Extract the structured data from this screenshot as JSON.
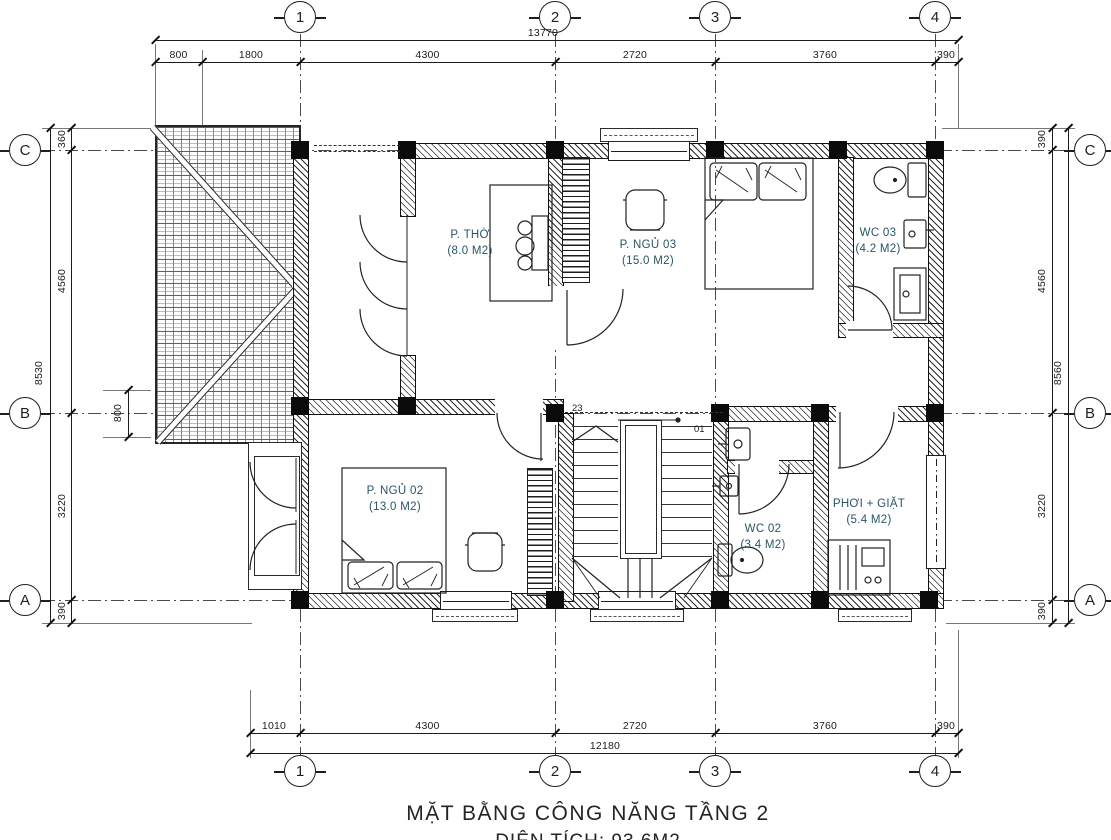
{
  "title": {
    "line1": "MẶT BẰNG CÔNG NĂNG TẦNG 2",
    "line2": "DIỆN TÍCH: 93.6M2"
  },
  "grid": {
    "cols": [
      "1",
      "2",
      "3",
      "4"
    ],
    "rows": [
      "C",
      "B",
      "A"
    ]
  },
  "dims": {
    "top": {
      "overall": "13770",
      "segments": [
        "800",
        "1800",
        "4300",
        "2720",
        "3760",
        "390"
      ]
    },
    "bottom": {
      "overall": "12180",
      "segments": [
        "1010",
        "4300",
        "2720",
        "3760",
        "390"
      ]
    },
    "left": {
      "overall": "8530",
      "segments": [
        "360",
        "4560",
        "3220",
        "390"
      ],
      "inner": "800"
    },
    "right": {
      "overall": "8560",
      "segments": [
        "390",
        "4560",
        "3220",
        "390"
      ]
    }
  },
  "rooms": [
    {
      "name": "P. THỜ",
      "area": "(8.0 M2)"
    },
    {
      "name": "P. NGỦ 03",
      "area": "(15.0 M2)"
    },
    {
      "name": "WC 03",
      "area": "(4.2 M2)"
    },
    {
      "name": "P. NGỦ 02",
      "area": "(13.0 M2)"
    },
    {
      "name": "WC 02",
      "area": "(3.4 M2)"
    },
    {
      "name": "PHƠI + GIẶT",
      "area": "(5.4 M2)"
    }
  ],
  "stairs": {
    "top_number": "23",
    "bottom_number": "01"
  },
  "colors": {
    "line": "#1c1c1c",
    "room_label": "#2a5564",
    "wall_fill": "#ffffff"
  }
}
